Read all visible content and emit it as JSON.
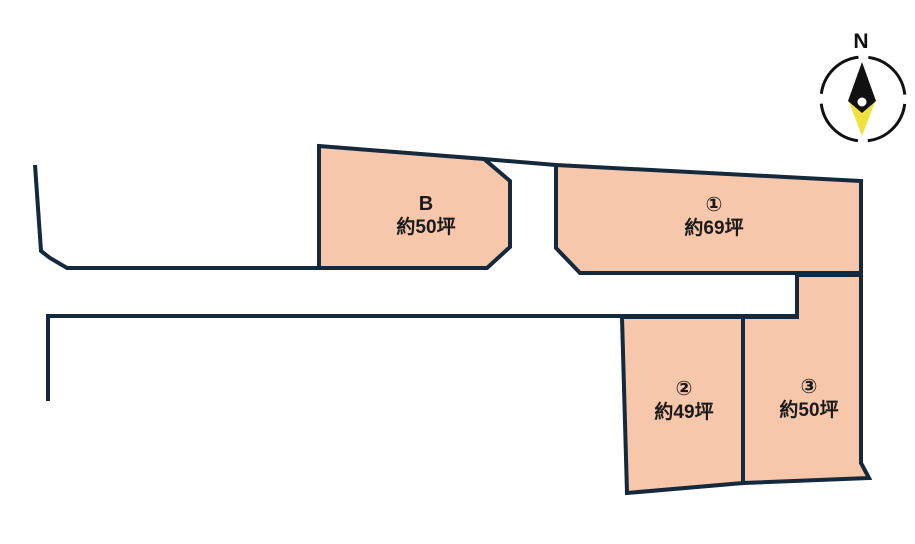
{
  "compass": {
    "north_label": "N"
  },
  "lots": [
    {
      "id": "B",
      "label": "B",
      "area": "約50坪"
    },
    {
      "id": "1",
      "label": "①",
      "area": "約69坪"
    },
    {
      "id": "2",
      "label": "②",
      "area": "約49坪"
    },
    {
      "id": "3",
      "label": "③",
      "area": "約50坪"
    }
  ],
  "colors": {
    "lot_fill": "#f6c7aa",
    "lot_outline": "#14293c",
    "road_line": "#14293c",
    "compass_ring": "#111111",
    "compass_needle_north": "#111111",
    "compass_needle_south": "#f0e23c",
    "compass_hub": "#ffffff",
    "label_text": "#1a1a1a",
    "background": "#ffffff"
  }
}
